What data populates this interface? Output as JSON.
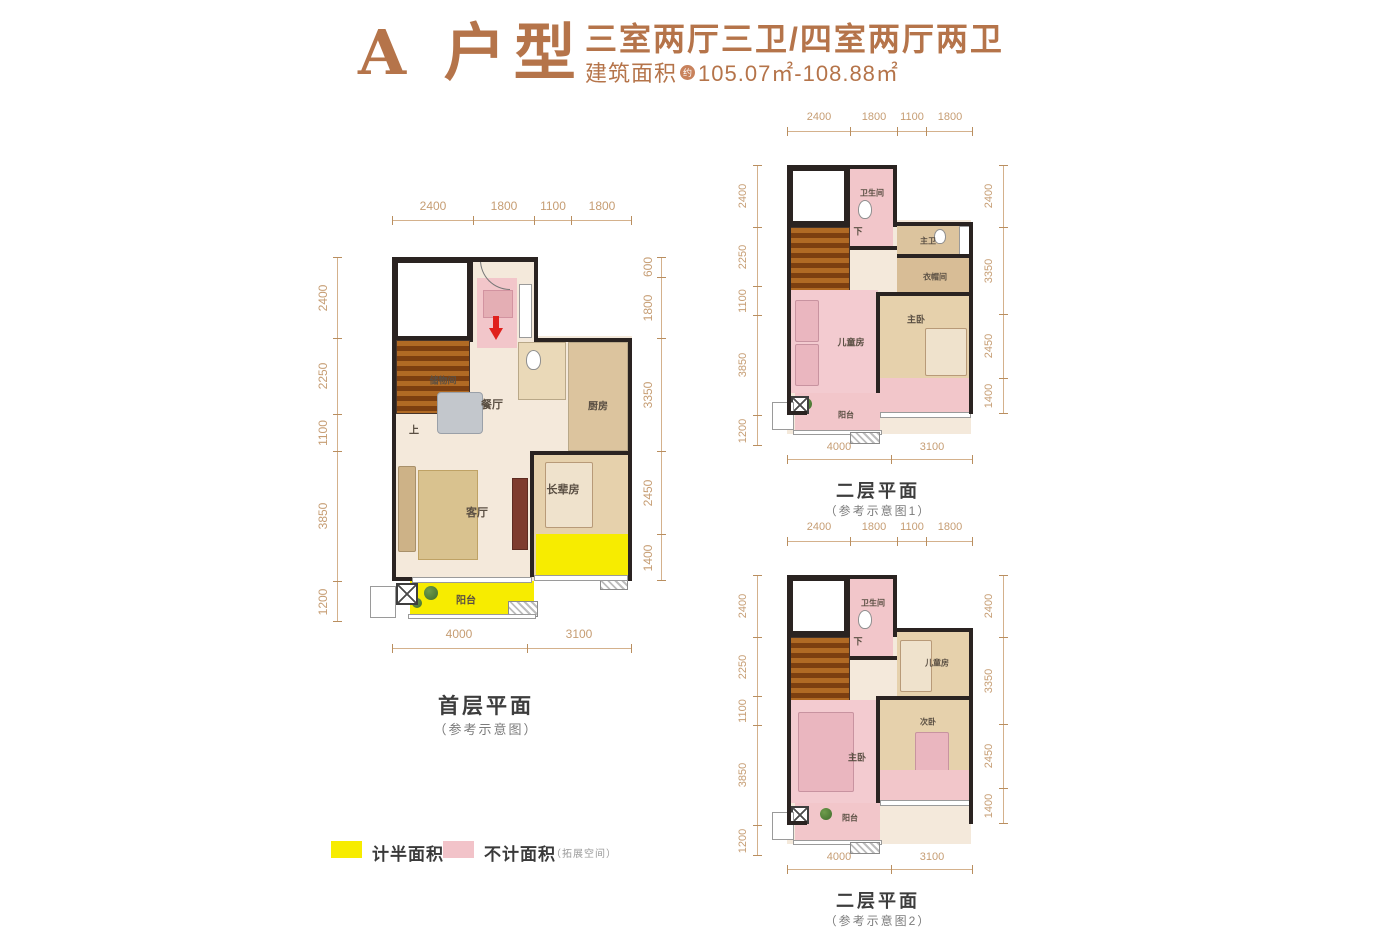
{
  "header": {
    "type_title": "A 户型",
    "layout_title": "三室两厅三卫/四室两厅两卫",
    "area_prefix": "建筑面积",
    "area_approx_badge": "约",
    "area_value": "105.07㎡-108.88㎡"
  },
  "legend": {
    "half_area_label": "计半面积",
    "excluded_label": "不计面积",
    "excluded_note": "（拓展空间）"
  },
  "colors": {
    "accent_brown": "#b5744a",
    "dimension_brown": "#c69d73",
    "wall_black": "#2a2321",
    "half_area_yellow": "#f7ec00",
    "excluded_pink": "#f2c6ca"
  },
  "plans": {
    "first": {
      "caption": "首层平面",
      "subcaption": "（参考示意图）",
      "dims_top": [
        "2400",
        "1800",
        "1100",
        "1800"
      ],
      "dims_bottom": [
        "4000",
        "3100"
      ],
      "dims_left": [
        "2400",
        "2250",
        "1100",
        "3850",
        "1200"
      ],
      "dims_right": [
        "600",
        "1800",
        "3350",
        "2450",
        "1400"
      ],
      "rooms": {
        "storage": "储物间",
        "dining": "餐厅",
        "kitchen": "厨房",
        "elder": "长辈房",
        "living": "客厅",
        "balcony": "阳台",
        "stairs": "上"
      }
    },
    "second_v1": {
      "caption": "二层平面",
      "subcaption": "（参考示意图1）",
      "dims_top": [
        "2400",
        "1800",
        "1100",
        "1800"
      ],
      "dims_bottom": [
        "4000",
        "3100"
      ],
      "dims_left": [
        "2400",
        "2250",
        "1100",
        "3850",
        "1200"
      ],
      "dims_right": [
        "2400",
        "3350",
        "2450",
        "1400"
      ],
      "rooms": {
        "bath": "卫生间",
        "master_bath": "主卫",
        "closet": "衣帽间",
        "kids": "儿童房",
        "master": "主卧",
        "balcony": "阳台",
        "stairs": "下"
      }
    },
    "second_v2": {
      "caption": "二层平面",
      "subcaption": "（参考示意图2）",
      "dims_top": [
        "2400",
        "1800",
        "1100",
        "1800"
      ],
      "dims_bottom": [
        "4000",
        "3100"
      ],
      "dims_left": [
        "2400",
        "2250",
        "1100",
        "3850",
        "1200"
      ],
      "dims_right": [
        "2400",
        "3350",
        "2450",
        "1400"
      ],
      "rooms": {
        "bath": "卫生间",
        "kids": "儿童房",
        "master": "主卧",
        "second": "次卧",
        "balcony": "阳台",
        "stairs": "下"
      }
    }
  }
}
